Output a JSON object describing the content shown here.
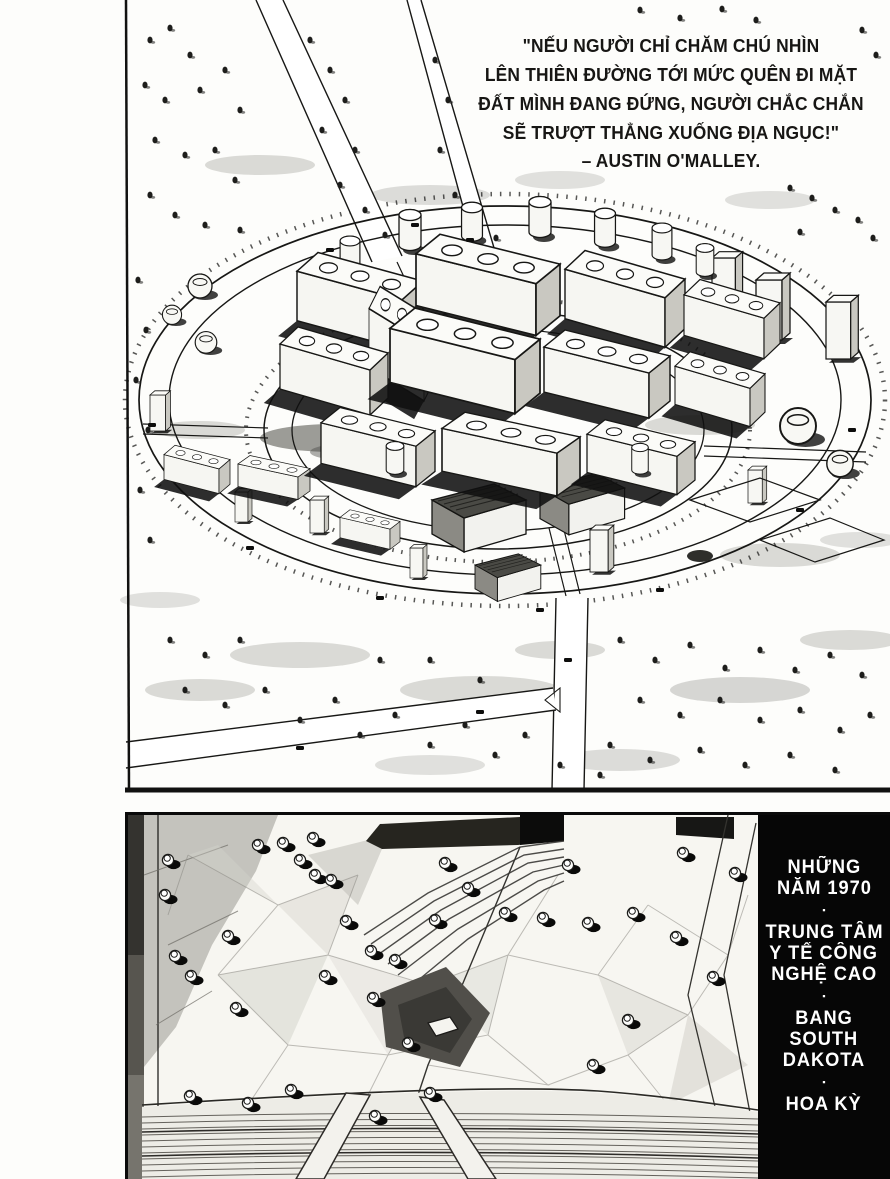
{
  "quote": {
    "lines": [
      "\"NẾU NGƯỜI CHỈ CHĂM CHÚ NHÌN",
      "LÊN THIÊN ĐƯỜNG TỚI MỨC QUÊN ĐI MẶT",
      "ĐẤT MÌNH ĐANG ĐỨNG, NGƯỜI CHẮC CHẮN",
      "SẼ TRƯỢT THẲNG XUỐNG ĐỊA NGỤC!\""
    ],
    "attribution": "– AUSTIN O'MALLEY."
  },
  "caption": {
    "groups": [
      {
        "lines": [
          "NHỮNG",
          "NĂM 1970"
        ]
      },
      {
        "lines": [
          "TRUNG TÂM",
          "Y TẾ CÔNG",
          "NGHỆ CAO"
        ]
      },
      {
        "lines": [
          "BANG",
          "SOUTH",
          "DAKOTA"
        ]
      },
      {
        "lines": [
          "HOA KỲ"
        ]
      }
    ],
    "separator": "▪"
  },
  "colors": {
    "ink": "#171614",
    "paper": "#fdfdfb",
    "caption_bg": "#060606",
    "caption_text": "#ffffff"
  }
}
